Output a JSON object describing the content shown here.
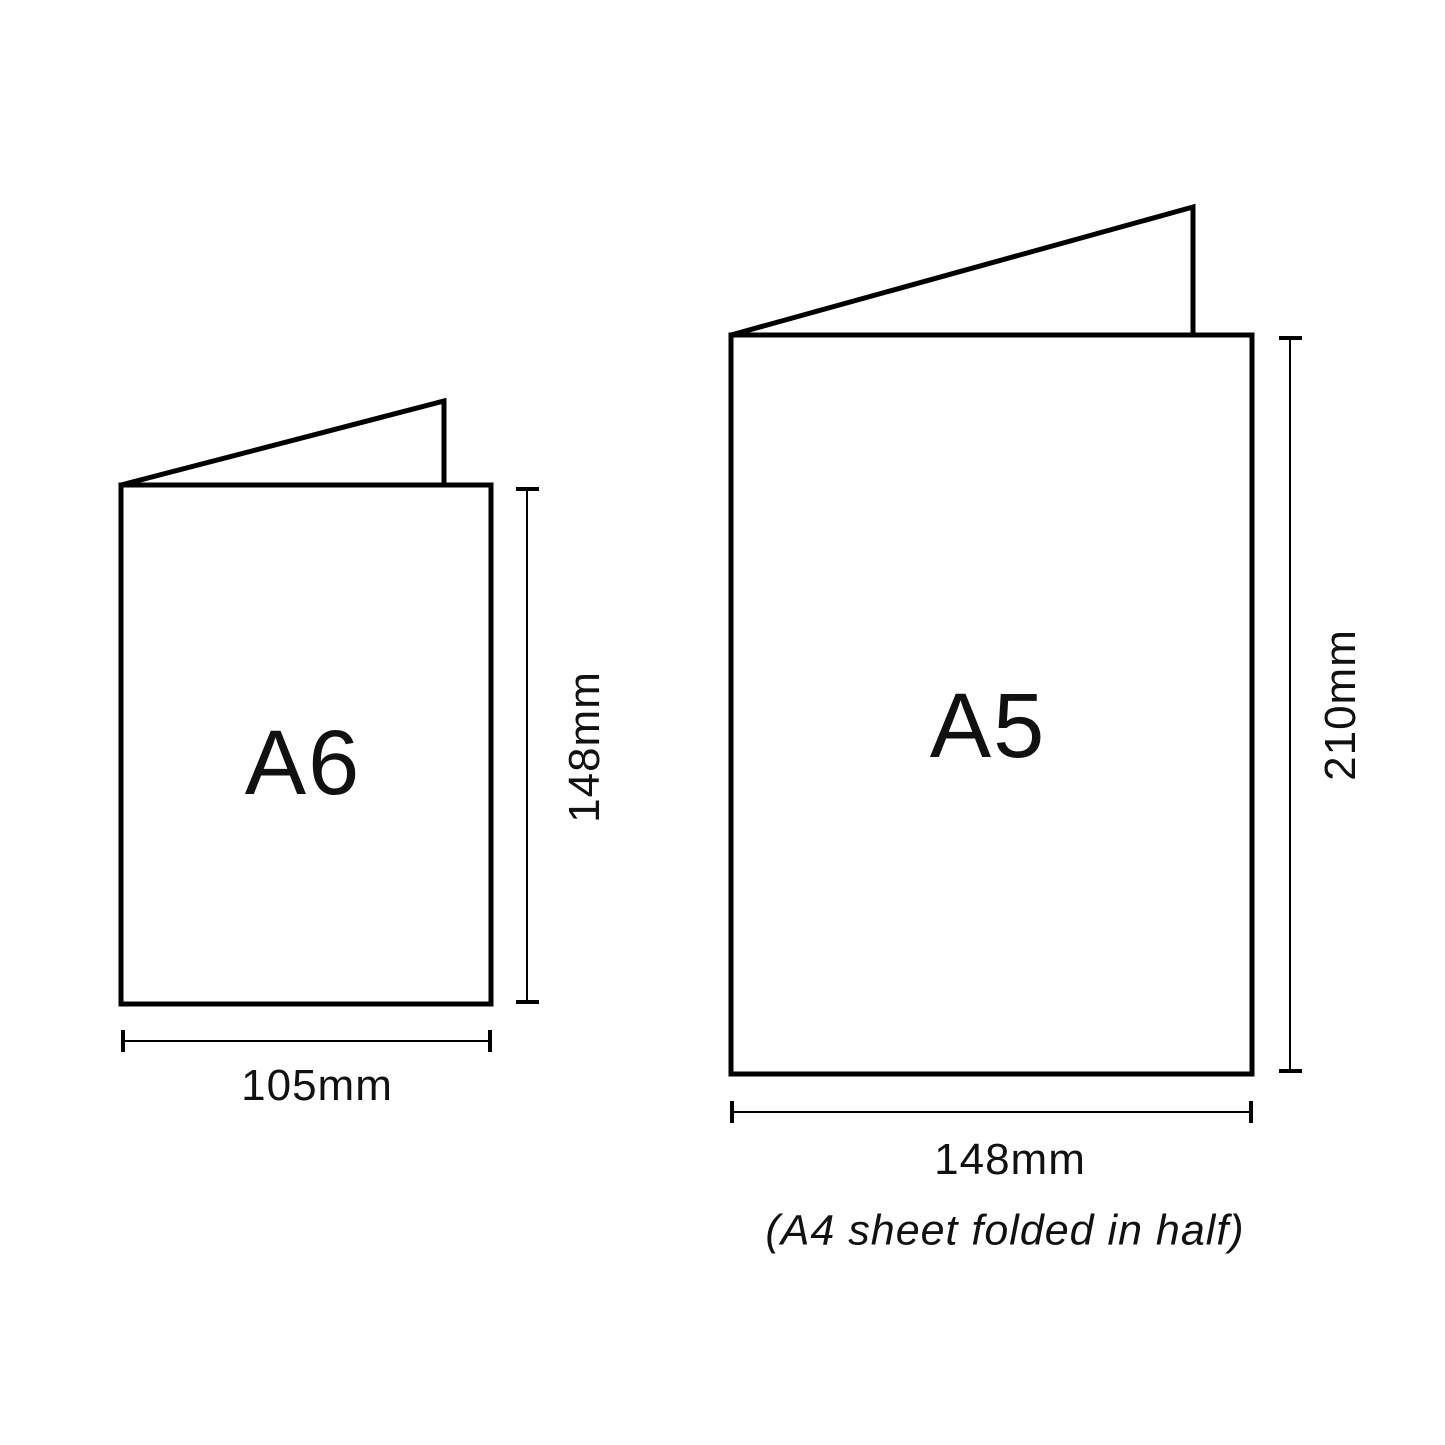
{
  "colors": {
    "line": "#000000",
    "text": "#111111",
    "card_fill": "#ffffff",
    "background": "#ffffff"
  },
  "cards": {
    "a6": {
      "label": "A6",
      "height_label": "148mm",
      "width_label": "105mm"
    },
    "a5": {
      "label": "A5",
      "height_label": "210mm",
      "width_label": "148mm",
      "note": "(A4 sheet folded in half)"
    }
  }
}
